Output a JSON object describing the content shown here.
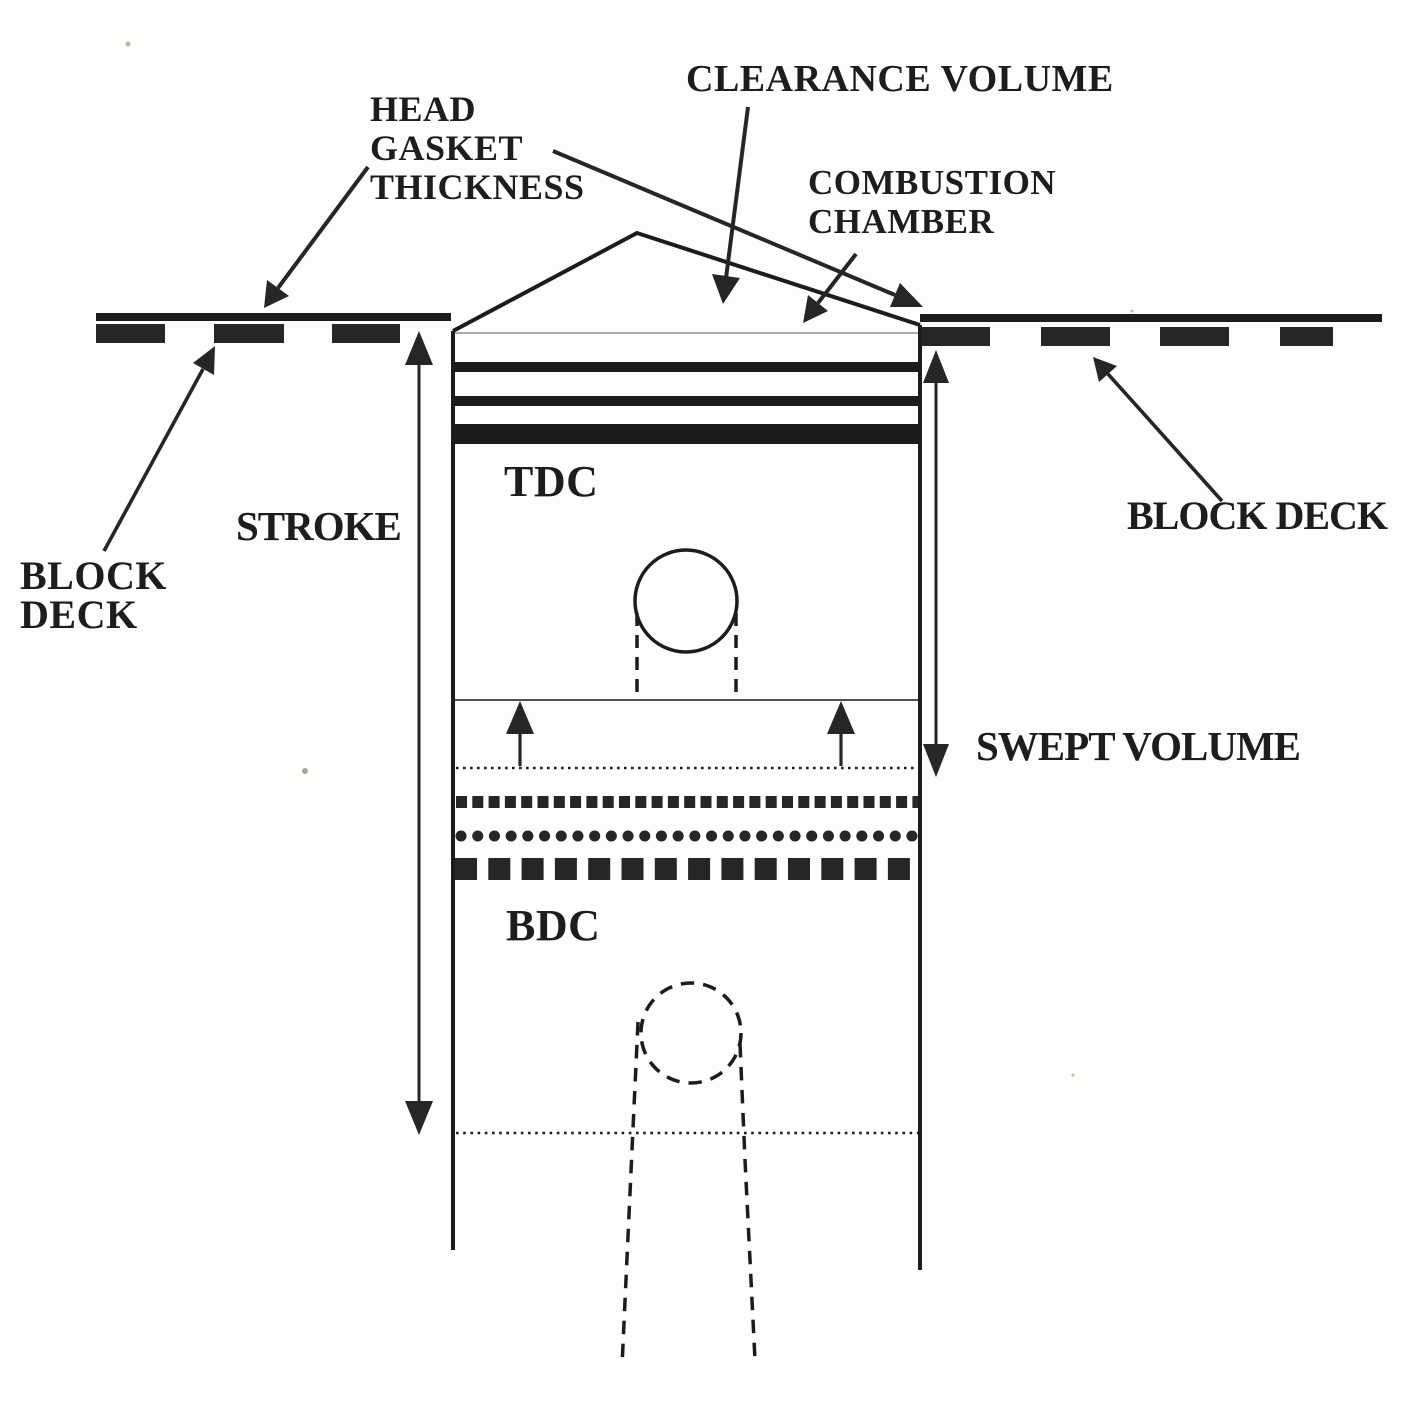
{
  "meta": {
    "figure": "engine cylinder stroke and volumes diagram",
    "ink_color": "#1c1c1c",
    "background_color": "#fdfdfb",
    "faint_line_color": "#909090"
  },
  "labels": {
    "clearance_volume": "CLEARANCE VOLUME",
    "head_gasket": {
      "line1": "HEAD",
      "line2": "GASKET",
      "line3": "THICKNESS"
    },
    "combustion_chamber": {
      "line1": "COMBUSTION",
      "line2": "CHAMBER"
    },
    "block_deck_left": {
      "line1": "BLOCK",
      "line2": "DECK"
    },
    "block_deck_right": "BLOCK DECK",
    "stroke": "STROKE",
    "swept_volume": "SWEPT VOLUME",
    "tdc": "TDC",
    "bdc": "BDC"
  }
}
